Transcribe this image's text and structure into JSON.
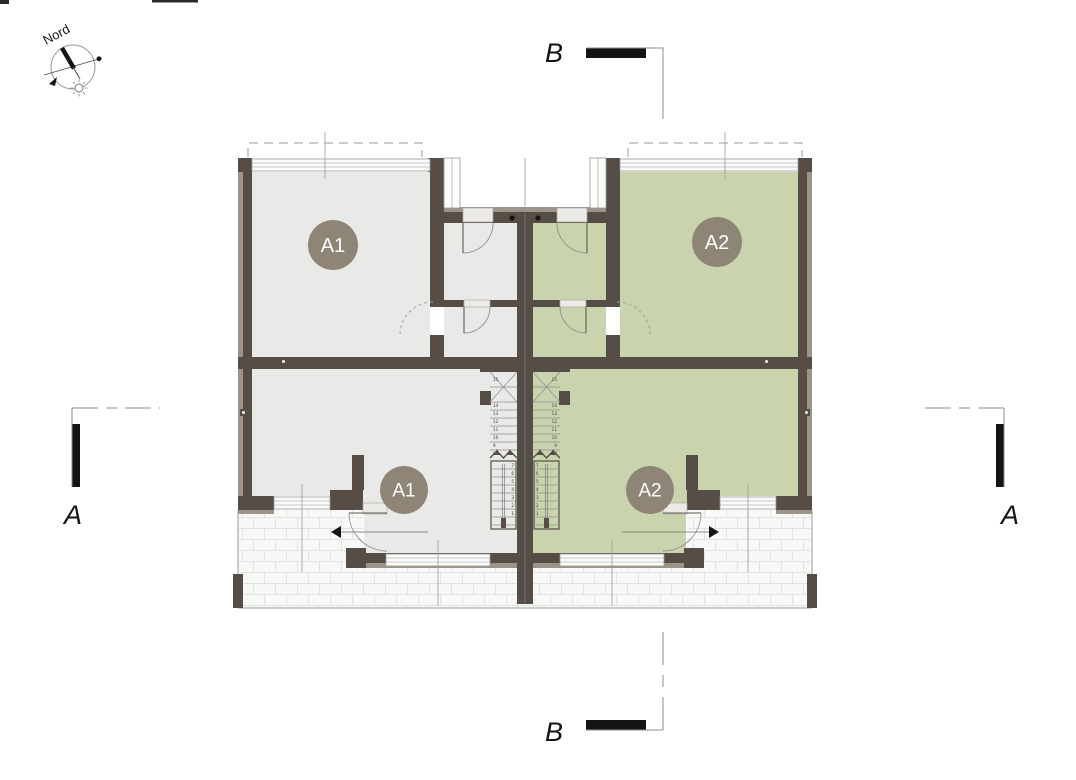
{
  "compass": {
    "label": "Nord"
  },
  "section_markers": {
    "top_label": "B",
    "bottom_label": "B",
    "left_label": "A",
    "right_label": "A"
  },
  "units": [
    {
      "id": "A1",
      "upper_room_label": "A1",
      "living_room_label": "A1",
      "fill": "#e9e9e8"
    },
    {
      "id": "A2",
      "upper_room_label": "A2",
      "living_room_label": "A2",
      "fill": "#c9d4ae"
    }
  ],
  "stairs": {
    "upper_tread_numbers": [
      "15",
      "14",
      "13",
      "12",
      "11",
      "10",
      "9",
      "8"
    ],
    "lower_tread_numbers": [
      "7",
      "6",
      "5",
      "4",
      "3",
      "2",
      "1"
    ]
  },
  "colors": {
    "wall": "#564e46",
    "wall_outer": "#9d9489",
    "badge_fill": "#8f8577",
    "badge_text": "#ffffff",
    "drawing_line": "#8f8f8f",
    "thin_line": "#9b9b9b",
    "tile_fill": "#f8f8f7",
    "tile_line": "#e3e3e1",
    "window_fill": "#fbfbfa",
    "threshold_fill": "#eceae6",
    "black": "#141414"
  }
}
